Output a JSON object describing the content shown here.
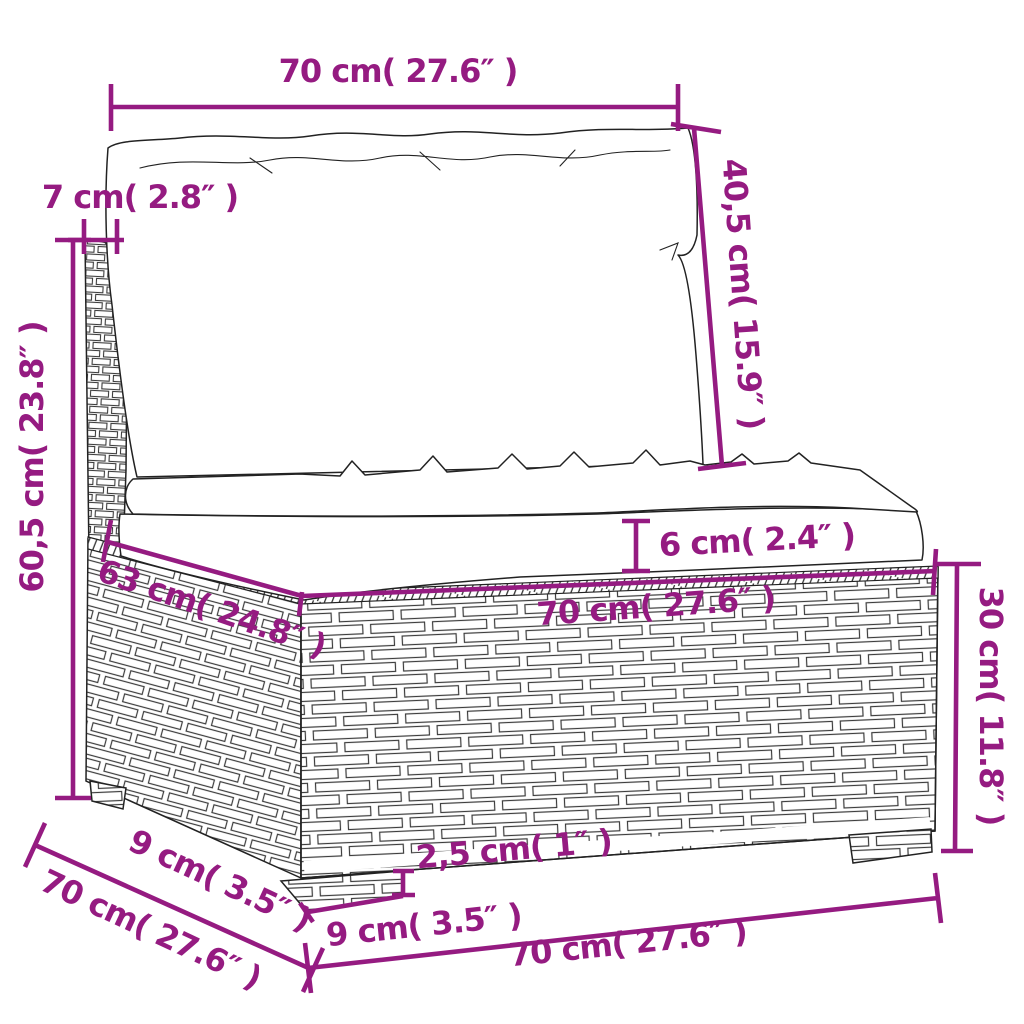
{
  "diagram": {
    "subject": "rattan-sofa-middle-section-with-cushions",
    "accent_color": "#951b81",
    "line_color": "#222222",
    "background_color": "#ffffff",
    "units": "cm / inches",
    "dims": {
      "top_width": {
        "label": "70 cm( 27.6″ )"
      },
      "back_cushion_height": {
        "label": "40,5 cm( 15.9″ )"
      },
      "back_thickness": {
        "label": "7 cm( 2.8″ )"
      },
      "total_height": {
        "label": "60,5 cm( 23.8″ )"
      },
      "seat_cushion_thickness": {
        "label": "6 cm( 2.4″ )"
      },
      "seat_depth": {
        "label": "63 cm( 24.8″ )"
      },
      "seat_width": {
        "label": "70 cm( 27.6″ )"
      },
      "base_height": {
        "label": "30 cm( 11.8″ )"
      },
      "leg_height": {
        "label": "2,5 cm( 1″ )"
      },
      "leg_width": {
        "label": "9 cm( 3.5″ )"
      },
      "leg_depth": {
        "label": "9 cm( 3.5″ )"
      },
      "total_depth": {
        "label": "70 cm( 27.6″ )"
      },
      "bottom_width": {
        "label": "70 cm( 27.6″ )"
      }
    }
  }
}
